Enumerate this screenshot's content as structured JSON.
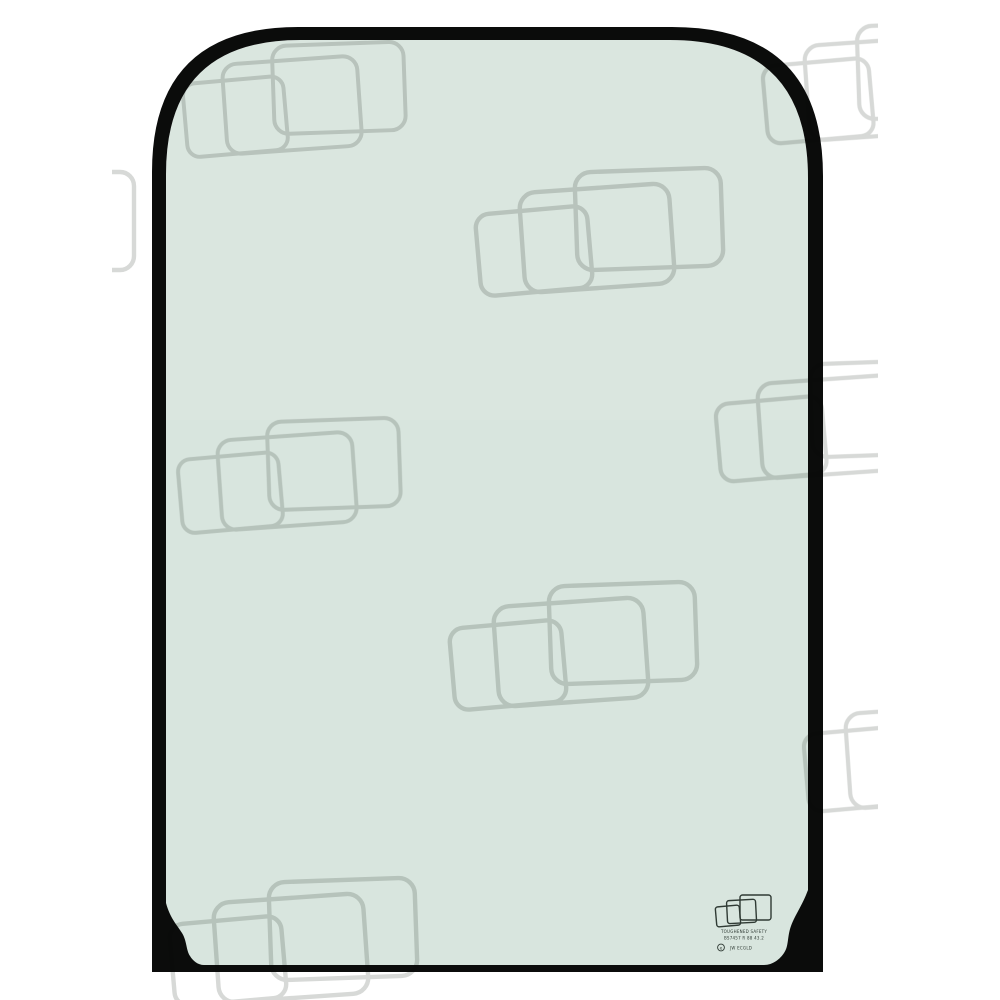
{
  "image": {
    "kind": "product-photo",
    "subject": "Replacement cab window glass panel (toughened safety glass) with black frame band, rounded top corners and notched bottom corners",
    "glass_description": "pale green tinted glass",
    "watermark_motif": "three overlapping rounded glass panes outline, tiled across photo"
  },
  "colors": {
    "background": "#ffffff",
    "glass_tint": "#d8e5de",
    "glass_highlight": "#ffffff",
    "frame": "#0b0c0b",
    "watermark": "#d7d9d7",
    "stamp_ink": "#2f3a34"
  },
  "stamp": {
    "line1": "TOUGHENED SAFETY",
    "line2": "BS7457 R 88 43.2",
    "mark": "e",
    "line3": "JW ECGLD"
  }
}
